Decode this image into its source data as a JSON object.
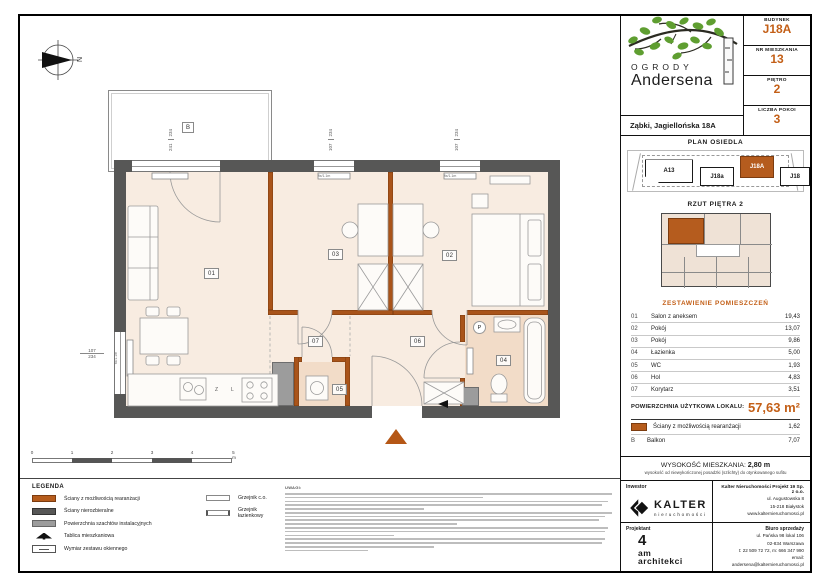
{
  "compass_label": "N",
  "header": {
    "logo_top": "OGRODY",
    "logo_bottom": "Andersena",
    "address": "Ząbki, Jagiellońska 18A",
    "info": [
      {
        "label": "BUDYNEK",
        "value": "J18A"
      },
      {
        "label": "NR MIESZKANIA",
        "value": "13"
      },
      {
        "label": "PIĘTRO",
        "value": "2"
      },
      {
        "label": "LICZBA POKOI",
        "value": "3"
      }
    ]
  },
  "site_plan": {
    "title": "PLAN OSIEDLA",
    "buildings": [
      "A13",
      "J18a",
      "J18A",
      "J18"
    ],
    "active_building": "J18A"
  },
  "floor_plan_thumb": {
    "title": "RZUT PIĘTRA 2"
  },
  "rooms_table": {
    "title": "ZESTAWIENIE POMIESZCZEŃ",
    "rows": [
      {
        "no": "01",
        "name": "Salon z aneksem",
        "area": "19,43"
      },
      {
        "no": "02",
        "name": "Pokój",
        "area": "13,07"
      },
      {
        "no": "03",
        "name": "Pokój",
        "area": "9,86"
      },
      {
        "no": "04",
        "name": "Łazienka",
        "area": "5,00"
      },
      {
        "no": "05",
        "name": "WC",
        "area": "1,93"
      },
      {
        "no": "06",
        "name": "Hol",
        "area": "4,83"
      },
      {
        "no": "07",
        "name": "Korytarz",
        "area": "3,51"
      }
    ],
    "total_label": "POWIERZCHNIA UŻYTKOWA LOKALU:",
    "total_value": "57,63 m²",
    "walls_row": {
      "name": "Ściany z możliwością rearanżacji",
      "area": "1,62"
    },
    "balcony_row": {
      "no": "B",
      "name": "Balkon",
      "area": "7,07"
    }
  },
  "height_box": {
    "label": "WYSOKOŚĆ MIESZKANIA:",
    "value": "2,80 m",
    "sub": "wysokość od niewykończonej posadzki (szlichty) do otynkowanego sufitu"
  },
  "footer": {
    "inwestor_label": "Inwestor",
    "kalter_name": "KALTER",
    "kalter_sub": "nieruchomości",
    "company_name": "Kalter Nieruchomości Projekt 19 Sp. z o.o.",
    "company_lines": [
      "ul. Augustowska 8",
      "15-218 Białystok",
      "www.kalternieruchomosci.pl"
    ],
    "projektant_label": "Projektant",
    "architect": {
      "l1": "4",
      "l2": "am",
      "l3": "architekci"
    },
    "sales_label": "Biuro sprzedaży",
    "sales_lines": [
      "ul. Pańska 98 lokal 106",
      "02-834 Warszawa",
      "t: 22 509 72 72, m: 666 347 990",
      "email: andersena@kalternieruchomosci.pl"
    ]
  },
  "legend": {
    "title": "LEGENDA",
    "left": [
      "Ściany z możliwością rearanżacji",
      "Ściany nierozbieralne",
      "Powierzchnia szachtów instalacyjnych",
      "Tablica mieszkaniowa",
      "Wymiar zestawu okiennego"
    ],
    "right": [
      "Grzejnik c.o.",
      "Grzejnik łazienkowy"
    ]
  },
  "notes_title": "UWAGI:",
  "plan": {
    "room_labels": [
      "01",
      "02",
      "03",
      "04",
      "05",
      "06",
      "07"
    ],
    "balcony_label": "B",
    "washer_label": "P",
    "kitchen_labels": [
      "Z",
      "L"
    ],
    "window_dims": [
      {
        "a": "241",
        "b": "234"
      },
      {
        "a": "107",
        "b": "234"
      },
      {
        "a": "107",
        "b": "234"
      },
      {
        "a": "107",
        "b": "234"
      }
    ],
    "window_note": "fix/1.1m",
    "scale_labels": [
      "0",
      "1",
      "2",
      "3",
      "4",
      "5 m"
    ]
  },
  "colors": {
    "accent": "#c35f17",
    "wall_dark": "#575756",
    "wall_orange": "#a9541a",
    "shaft": "#9c9c9c",
    "floor": "#f8ece1"
  }
}
